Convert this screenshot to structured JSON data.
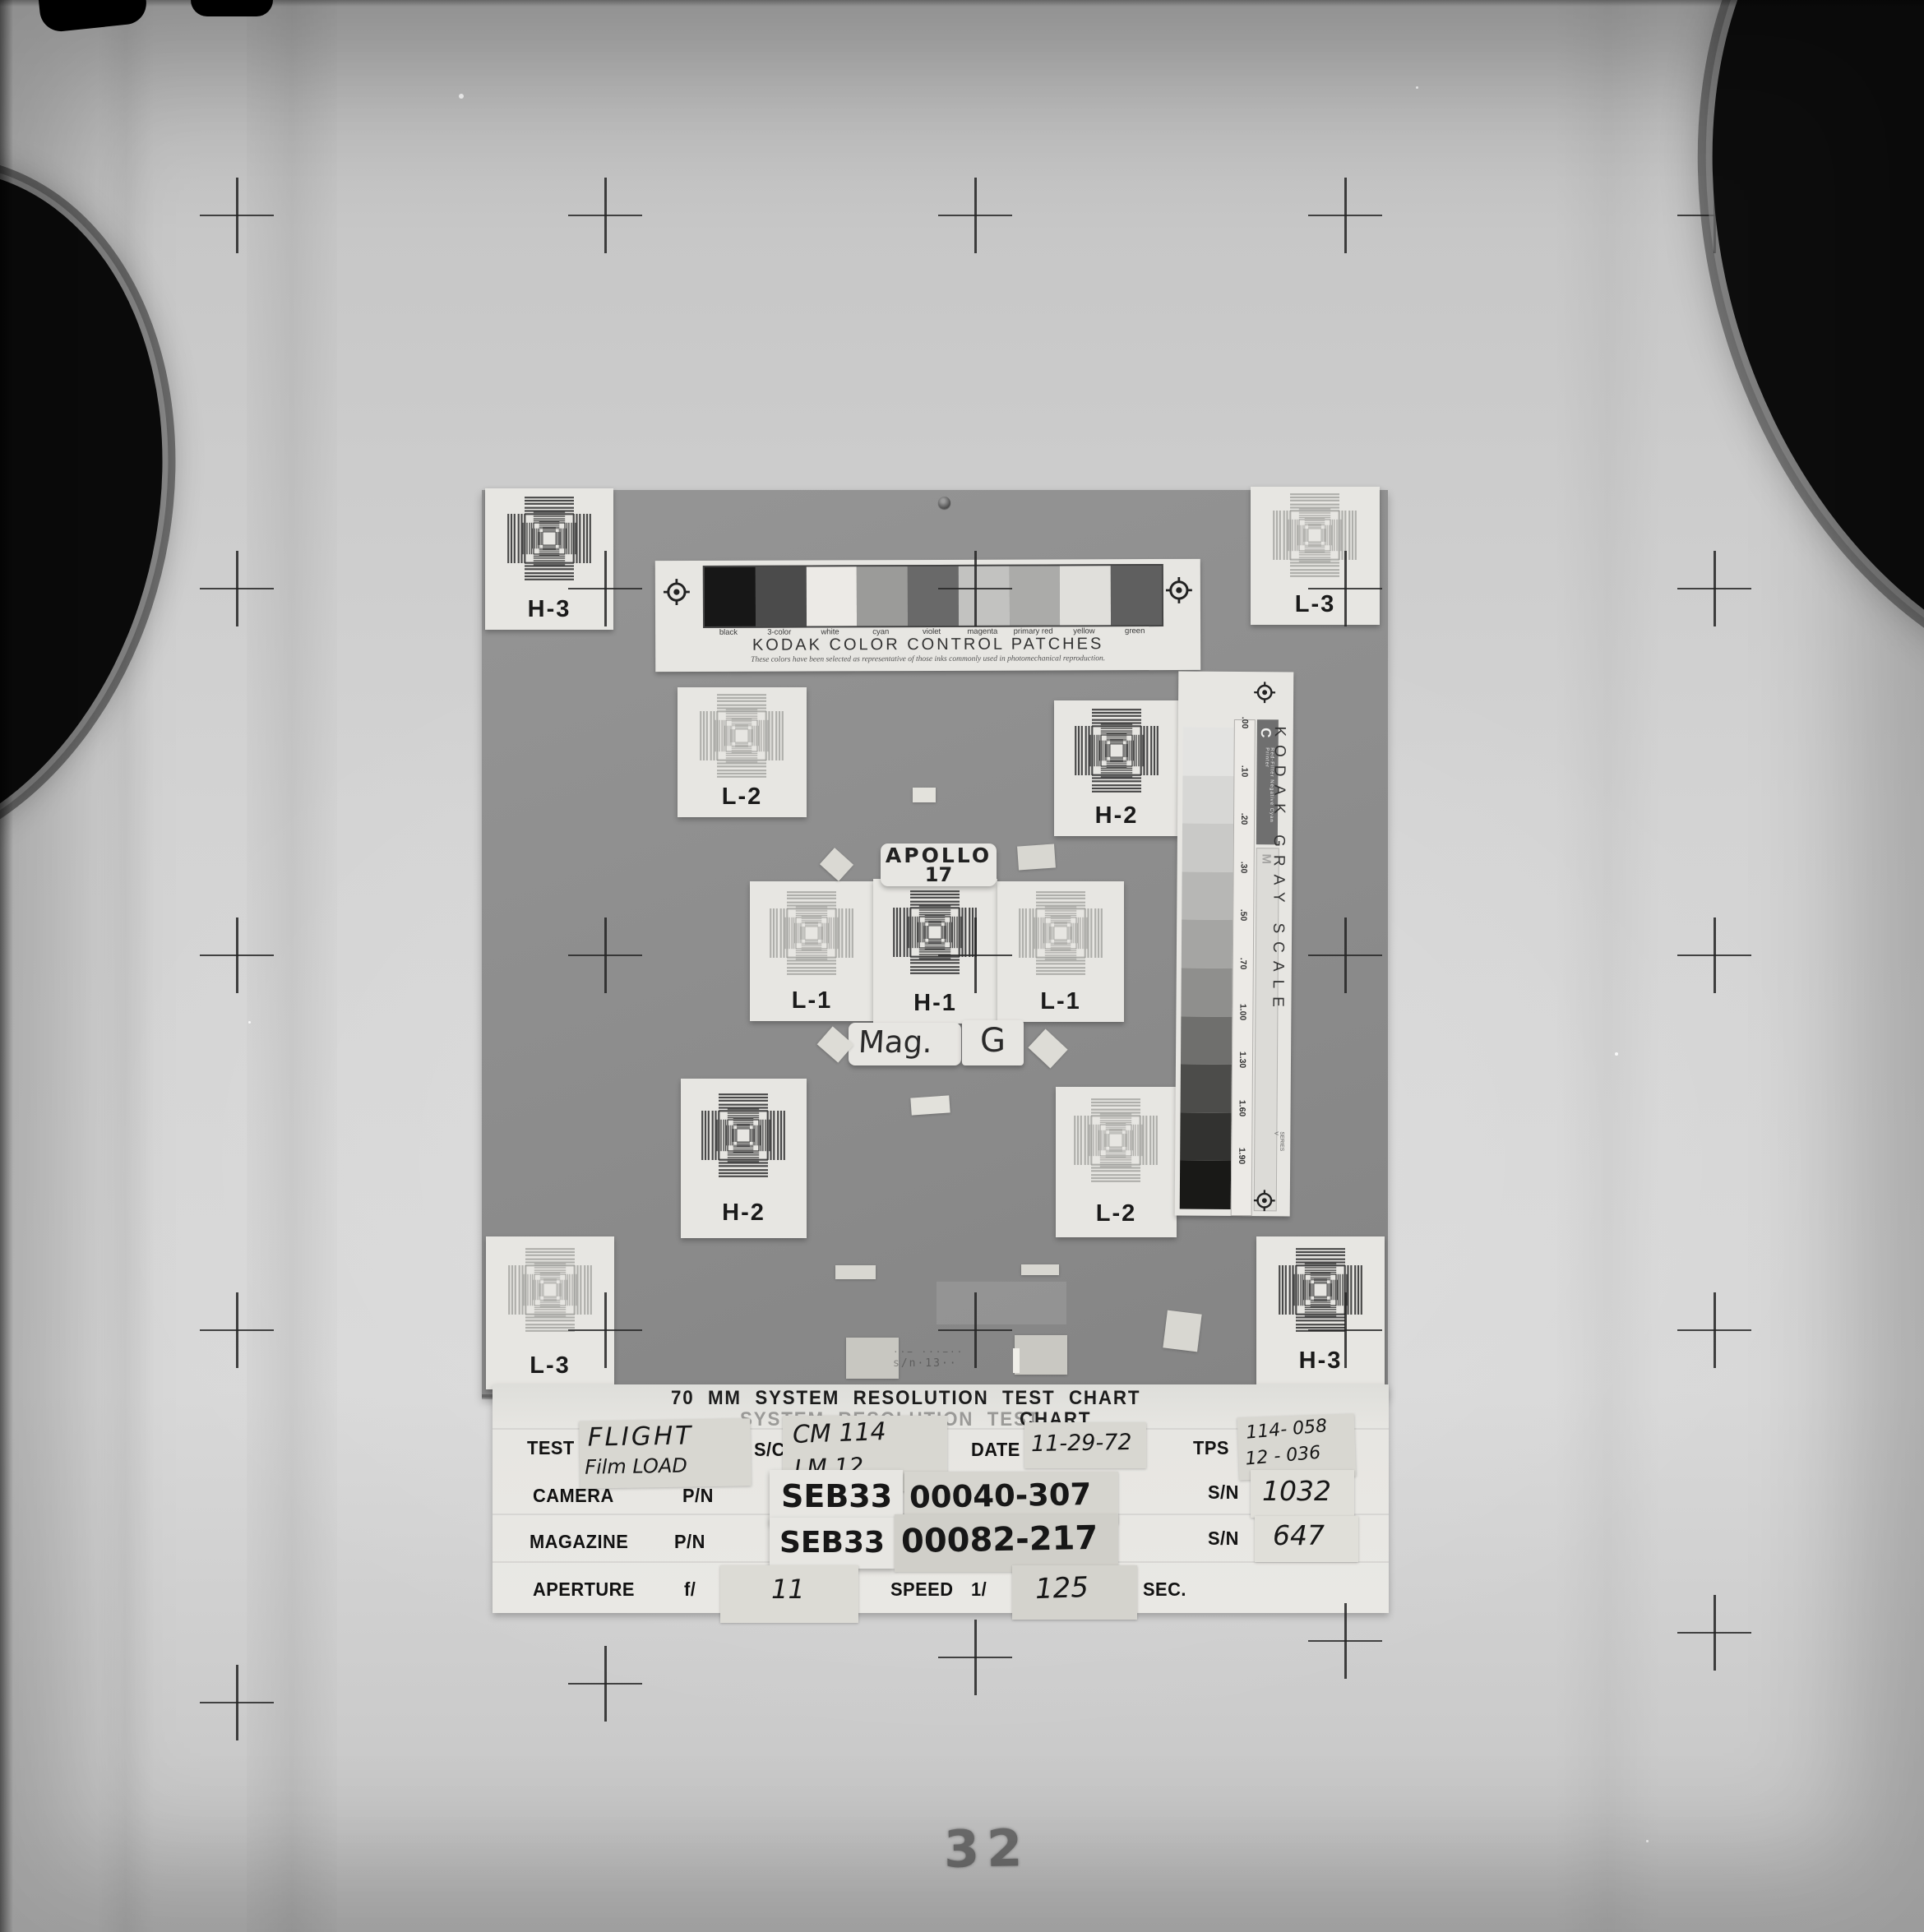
{
  "photo": {
    "frame_number": "32"
  },
  "labels": {
    "apollo_line1": "APOLLO",
    "apollo_line2": "17",
    "mag": "Mag.",
    "mag_letter": "G"
  },
  "targets": [
    {
      "label": "H-3",
      "type": "H"
    },
    {
      "label": "L-3",
      "type": "L"
    },
    {
      "label": "L-2",
      "type": "L"
    },
    {
      "label": "H-2",
      "type": "H"
    },
    {
      "label": "L-1",
      "type": "L"
    },
    {
      "label": "H-1",
      "type": "H"
    },
    {
      "label": "L-1",
      "type": "L"
    },
    {
      "label": "H-2",
      "type": "H"
    },
    {
      "label": "L-2",
      "type": "L"
    },
    {
      "label": "L-3",
      "type": "L"
    },
    {
      "label": "H-3",
      "type": "H"
    }
  ],
  "color_patches": {
    "title": "KODAK COLOR CONTROL PATCHES",
    "subtitle": "These colors have been selected as representative of those inks commonly used in photomechanical reproduction.",
    "patches": [
      {
        "label": "black",
        "tone": "#171717"
      },
      {
        "label": "3-color",
        "tone": "#4b4b4b"
      },
      {
        "label": "white",
        "tone": "#eceae6"
      },
      {
        "label": "cyan",
        "tone": "#9b9b99"
      },
      {
        "label": "violet",
        "tone": "#696969"
      },
      {
        "label": "magenta",
        "tone": "#c2c2c0"
      },
      {
        "label": "primary red",
        "tone": "#ababa9"
      },
      {
        "label": "yellow",
        "tone": "#e0dfdb"
      },
      {
        "label": "green",
        "tone": "#5f5f5f"
      }
    ]
  },
  "gray_scale": {
    "title": "KODAK GRAY SCALE",
    "series": "SERIES V",
    "column_c_label": "C",
    "column_c_text": "Red-Filter Negative   Cyan Printer",
    "column_m_label": "M",
    "densities": [
      ".00",
      ".10",
      ".20",
      ".30",
      ".50",
      ".70",
      "1.00",
      "1.30",
      "1.60",
      "1.90"
    ],
    "patch_tones": [
      "#e3e3e1",
      "#d7d7d5",
      "#c9c9c7",
      "#b7b7b5",
      "#a5a5a3",
      "#8f8f8d",
      "#6f6f6d",
      "#4c4c4a",
      "#323230",
      "#191917"
    ]
  },
  "data_panel": {
    "title_line1": "70 MM  SYSTEM  RESOLUTION  TEST  CHART",
    "title_line2_ghost": "SYSTEM  RESOLUTION  TEST",
    "title_line2_solid": "CHART",
    "test_label": "TEST",
    "test_value_line1": "FLIGHT",
    "test_value_line2": "Film LOAD",
    "sc_label": "S/C",
    "sc_value_line1": "CM 114",
    "sc_value_line2": "LM 12",
    "date_label": "DATE",
    "date_value": "11-29-72",
    "tps_label": "TPS",
    "tps_value_line1": "114- 058",
    "tps_value_line2": "12 - 036",
    "camera_label": "CAMERA",
    "camera_pn_label": "P/N",
    "camera_pn_prefix": "SEB33",
    "camera_pn_value": "00040-307",
    "camera_sn_label": "S/N",
    "camera_sn_value": "1032",
    "magazine_label": "MAGAZINE",
    "magazine_pn_label": "P/N",
    "magazine_pn_prefix": "SEB33",
    "magazine_pn_value": "00082-217",
    "magazine_sn_label": "S/N",
    "magazine_sn_value": "647",
    "aperture_label": "APERTURE",
    "aperture_f_label": "f/",
    "aperture_f_value": "11",
    "speed_label": "SPEED",
    "speed_prefix": "1/",
    "speed_value": "125",
    "sec_label": "SEC."
  },
  "board": {
    "stencil_line1": "··− ···−··",
    "stencil_line2": "s/n·13··"
  }
}
